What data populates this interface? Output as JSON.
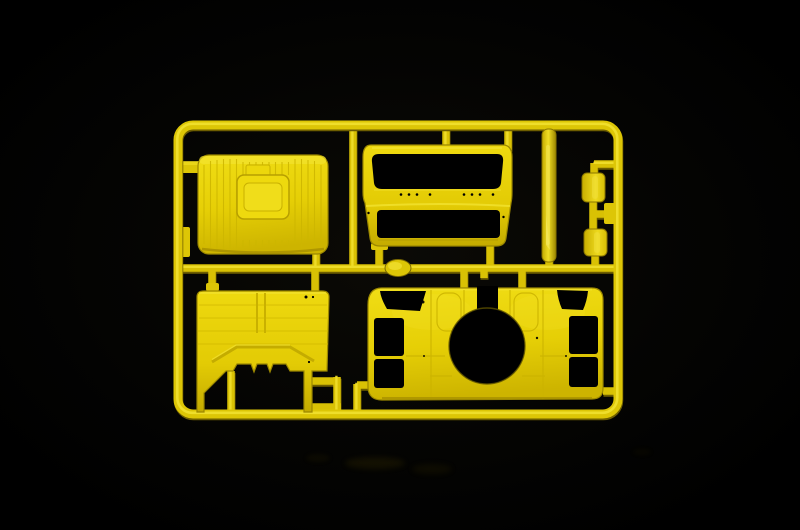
{
  "image": {
    "type": "photograph",
    "subject": "Injection-molded yellow plastic model-kit sprue (parts tree) with truck cab parts, photographed on a black background"
  },
  "colors": {
    "background": "#000000",
    "plastic": "#e3cb05",
    "plastic_bright": "#f4e537",
    "plastic_mid": "#d9c104",
    "plastic_dark": "#8a7600",
    "plastic_deep": "#5f5200",
    "hole_black": "#000000"
  },
  "sprue": {
    "frame_name": "Rectangular sprue frame with rounded corners and runner bars",
    "runners_name": "Connecting runners and gates",
    "parts": [
      {
        "id": "roof-panel",
        "name": "Cab roof panel with ribbed surface and raised sunroof hatch",
        "position": "top-left"
      },
      {
        "id": "cab-front",
        "name": "Cab front panel with windshield opening, hinge holes and grille opening",
        "position": "top-center"
      },
      {
        "id": "trim-strip",
        "name": "Long narrow trim strip (sun visor bar)",
        "position": "top-right"
      },
      {
        "id": "mirror-upper",
        "name": "Upper mirror housing block",
        "position": "right, upper"
      },
      {
        "id": "mirror-lower",
        "name": "Lower mirror housing block",
        "position": "right, lower"
      },
      {
        "id": "cab-back-panel",
        "name": "Cab rear wall panel with stepped engine-tunnel notch",
        "position": "bottom-left"
      },
      {
        "id": "cab-floor-sides",
        "name": "Cab side walls / floor piece with large circular engine-tunnel opening, window and door cutouts",
        "position": "bottom-right"
      }
    ],
    "reflection_name": "Faint reflection of the sprue on the dark surface"
  }
}
